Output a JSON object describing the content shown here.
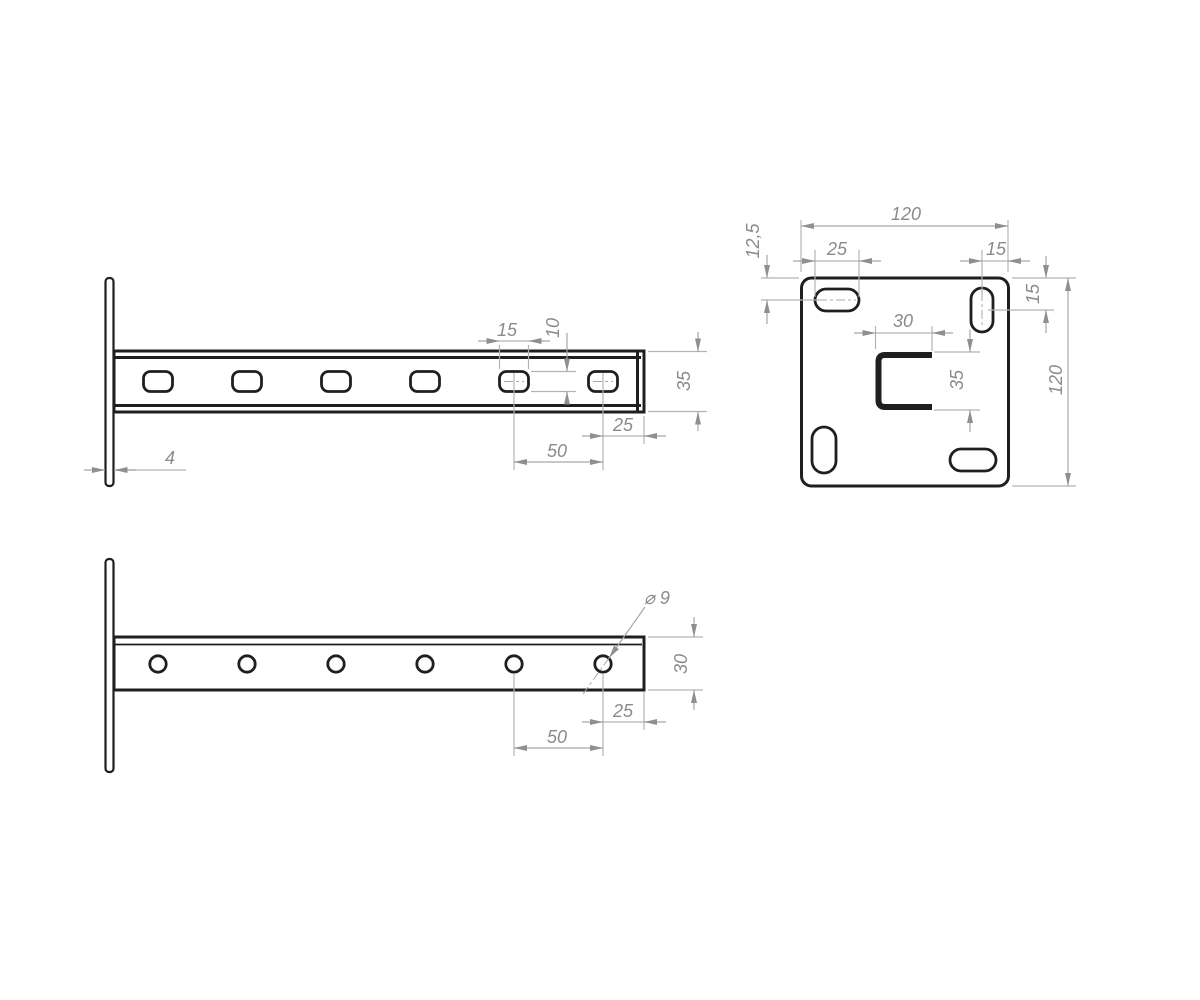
{
  "meta": {
    "drawing_type": "engineering-drawing-wall-cantilever-bracket",
    "colors": {
      "background": "#ffffff",
      "outline": "#1f1f1f",
      "dimension_line": "#b3b3b3",
      "dimension_text": "#8a8a8a"
    }
  },
  "side_view": {
    "dims": {
      "slot_length": "15",
      "slot_width": "10",
      "beam_height": "35",
      "end_to_slot": "25",
      "slot_pitch": "50",
      "plate_thickness": "4"
    }
  },
  "plate_view": {
    "dims": {
      "width_top": "120",
      "height_right": "120",
      "slot_length": "25",
      "slot_edge_offset": "15",
      "slot_center_top_offset": "12,5",
      "slot_center_right_offset": "15",
      "channel_width": "30",
      "channel_height": "35"
    }
  },
  "top_view": {
    "dims": {
      "hole_diameter": "⌀ 9",
      "beam_width": "30",
      "end_to_hole": "25",
      "hole_pitch": "50"
    }
  }
}
